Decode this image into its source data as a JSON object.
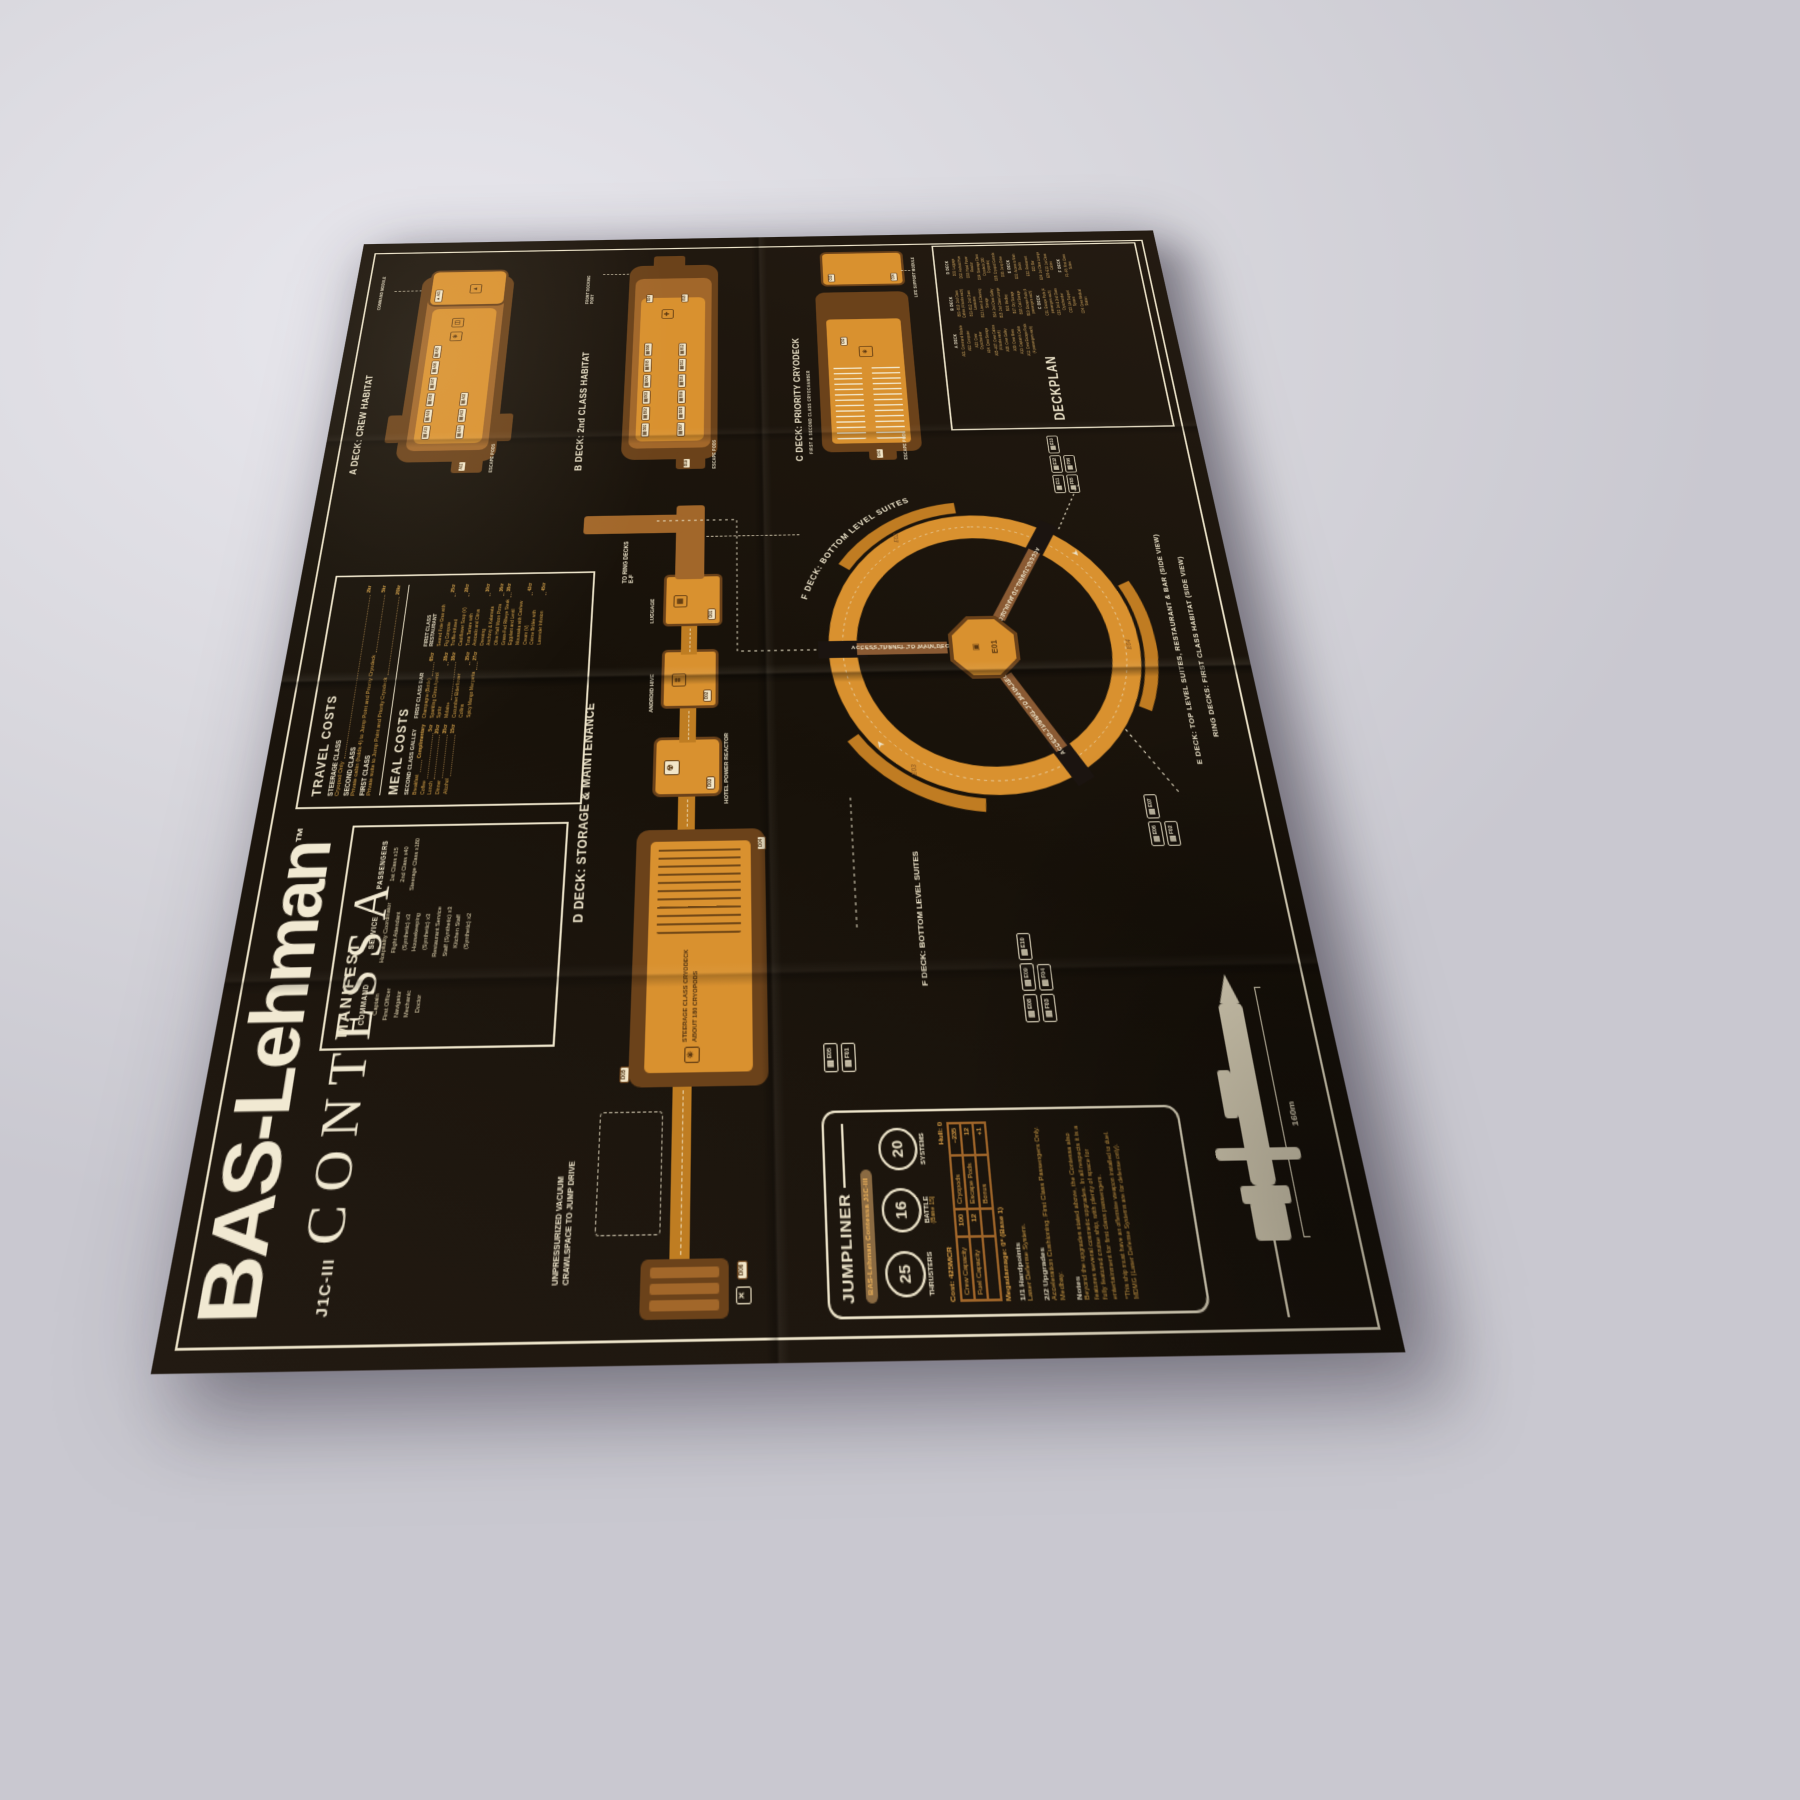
{
  "colors": {
    "accent_orange": "#d9912f",
    "deep_brown": "#6b421a",
    "cream": "#ece3c9",
    "mid_brown": "#a2672a",
    "gold_text": "#d9a449",
    "background": "#1b1410"
  },
  "icons": {
    "bunk": "▤",
    "window": "◫",
    "cryo": "✳",
    "reactor": "☢",
    "luggage": "▦",
    "hive": "⌗",
    "command": "▲",
    "medical": "✚",
    "jump": "✕",
    "hub": "▣",
    "columns": "⌸"
  },
  "masthead": {
    "brand": "BAS-Lehman",
    "tm": "™",
    "model": "J1C-III",
    "name": "CONTESSA"
  },
  "manifest": {
    "header": "MANIFEST",
    "command": {
      "title": "COMMAND",
      "items": [
        "Captain",
        "First Officer",
        "Navigator",
        "Mechanic",
        "Doctor"
      ]
    },
    "service": {
      "title": "SERVICE",
      "items": [
        "Hospitality Coordinator",
        "Flight Attendant (Synthetic) x3",
        "Housekeeping (Synthetic) x3",
        "Restaurant Service Staff (Synthetic) x3",
        "Kitchen Staff (Synthetic) x2"
      ]
    },
    "passengers": {
      "title": "PASSENGERS",
      "items": [
        "1st Class x15",
        "2nd Class x40",
        "Steerage Class x180"
      ]
    }
  },
  "costs": {
    "travel_header": "TRAVEL COSTS",
    "travel": [
      {
        "cls": "STEERAGE CLASS",
        "desc": "Cryopod Only",
        "price": "2kr"
      },
      {
        "cls": "SECOND CLASS",
        "desc": "Private cabin (holds 4) to Jump Point and Priority Cryodeck",
        "price": "5kr"
      },
      {
        "cls": "FIRST CLASS",
        "desc": "Private suite to Jump Point and Priority Cryodeck",
        "price": "20kr"
      }
    ],
    "meal_header": "MEAL COSTS",
    "galley": {
      "title": "SECOND CLASS GALLEY",
      "items": [
        {
          "n": "Breakfast",
          "p": "Complimentary"
        },
        {
          "n": "Coffee",
          "p": "5cr"
        },
        {
          "n": "Lunch",
          "p": "20cr"
        },
        {
          "n": "Dinner",
          "p": "35cr"
        },
        {
          "n": "Alcohol",
          "p": "15cr"
        }
      ]
    },
    "bar": {
      "title": "FIRST CLASS BAR",
      "items": [
        {
          "n": "Champagne (Bottle)",
          "p": "65cr"
        },
        {
          "n": "Sparkling Citrus Aperol Spritz",
          "p": "28cr"
        },
        {
          "n": "Molais+",
          "p": "38cr"
        },
        {
          "n": "Cucumber Elderflower Collins",
          "p": "35cr"
        },
        {
          "n": "Spicy Mango Margarita",
          "p": "27cr"
        }
      ]
    },
    "restaurant": {
      "title": "FIRST CLASS RESTAURANT",
      "items": [
        {
          "n": "Seared Foie Gras with Fig Compote",
          "p": "25cr"
        },
        {
          "n": "Truffle-infused Cauliflower Soup (V)",
          "p": "28cr"
        },
        {
          "n": "Tuna Tartare with Avocado and Citrus Dressing",
          "p": "30cr"
        },
        {
          "n": "Anchovy & Kalamata Olive Half Moon Pizza",
          "p": "36cr"
        },
        {
          "n": "Grass-Fed Ribeye Steak",
          "p": "38cr"
        },
        {
          "n": "Eggplant and Lentil Moussaka with Cashew Cream (V)",
          "p": "42cr"
        },
        {
          "n": "Crème Brûlée with Lavender Infusion",
          "p": "45cr"
        }
      ]
    }
  },
  "decks": {
    "a": {
      "title": "A DECK: CREW HABITAT",
      "row1": [
        "A10",
        "A09",
        "A08",
        "A07",
        "A06",
        "A05"
      ],
      "row2": [
        "A04",
        "A03",
        "A02"
      ]
    },
    "b": {
      "title": "B DECK: 2nd CLASS HABITAT",
      "row1": [
        "B01",
        "B02",
        "B03",
        "B04",
        "B05",
        "B06"
      ],
      "row2": [
        "B07",
        "B08",
        "B09",
        "B10",
        "B11",
        "B12"
      ]
    },
    "c": {
      "title": "C DECK: PRIORITY CRYODECK"
    },
    "d": {
      "title": "D DECK: STORAGE & MAINTENANCE"
    }
  },
  "rooms": {
    "a01": "A01",
    "a11": "A11",
    "b14": "B14",
    "b15": "B15",
    "b19": "B19",
    "c01": "C01",
    "c02": "C02",
    "c03": "C03",
    "c04": "C04",
    "d01": "D01",
    "d02": "D02",
    "d03": "D03",
    "d04": "D04",
    "d05": "D05",
    "d06": "D06",
    "e01": "E01"
  },
  "ann": {
    "escape_pods": "ESCAPE PODS",
    "command_module": "COMMAND MODULE",
    "front_docking": "FRONT DOCKING PORT",
    "life_support": "LIFE SUPPORT MODULE",
    "cryochamber": "FIRST & SECOND CLASS CRYOCHAMBER",
    "to_ring": "TO RING DECKS E-F",
    "luggage": "LUGGAGE",
    "android_hive": "ANDROID HIVE",
    "reactor": "HOTEL POWER REACTOR",
    "steerage1": "STEERAGE CLASS CRYODECK",
    "steerage2": "ABOUT 180 CRYOPODS",
    "crawl1": "UNPRESSURIZED VACUUM",
    "crawl2": "CRAWLSPACE TO JUMP DRIVE",
    "access_tunnel": "ACCESS TUNNEL TO MAIN DECKS"
  },
  "ring": {
    "f_curved": "F DECK: BOTTOM LEVEL SUITES",
    "f_label": "F DECK: BOTTOM LEVEL SUITES",
    "e_label": "E DECK: TOP LEVEL SUITES, RESTAURANT & BAR (SIDE VIEW)",
    "ring_label": "RING DECKS: FIRST CLASS HABITAT (SIDE VIEW)",
    "e02": "E02",
    "e03": "E03",
    "e04": "E04",
    "clusters": {
      "c1e": [
        "E05"
      ],
      "c1f": [
        "F01"
      ],
      "c2e": [
        "E06",
        "E07"
      ],
      "c2f": [
        "F02"
      ],
      "c3e": [
        "E08",
        "E09",
        "E10"
      ],
      "c3f": [
        "F03",
        "F04"
      ],
      "c4e": [
        "E11",
        "E12",
        "E13"
      ],
      "c4f": [
        "F05",
        "F06"
      ]
    }
  },
  "deckplan": {
    "header": "DECKPLAN",
    "a": {
      "title": "A DECK",
      "items": [
        "A01: Command Module",
        "A02: Computer",
        "A03: Crew Cryochamber",
        "A04: Crew Storage",
        "A05–A07: Crew Cabins (4 bunks each)",
        "A08: Crew Galley",
        "A09: Crew Mess",
        "A10: Captain's Cabin",
        "A11: Crew Escape Pods (4 passengers each)"
      ]
    },
    "b": {
      "title": "B DECK",
      "items": [
        "B01–B10: 2nd Class Cabins (4 bunks each)",
        "B11–B12: 2nd Class Lavatories",
        "B13: Linen & Cleaning Storage",
        "B14: 2nd Class Galley",
        "B15: 2nd Class Lounge",
        "B16: Medbay",
        "B17: Dry Storage",
        "B18: Cold Storage",
        "B19: Escape Pods (4 passengers each)"
      ]
    },
    "c": {
      "title": "C DECK",
      "items": [
        "C01: Escape Pods (4 passengers each)",
        "C02: 1st & 2nd Class Cryochamber",
        "C03: Life Support System",
        "C04: Crew Medical Station"
      ]
    },
    "d": {
      "title": "D DECK",
      "items": [
        "D01: Luggage",
        "D02: Android Hive",
        "D03: Hotel Power Reactor",
        "D04: Steerage Class Cryodeck (180 Cryopods)",
        "D05: Cryopod Controls",
        "D06: Jump Drive"
      ]
    },
    "e": {
      "title": "E DECK",
      "items": [
        "E01: Access to Main Decks",
        "E02: Restaurant",
        "E03: Bar",
        "E04: 1st Class Lounge",
        "E05–E13: 1st Class Cabins"
      ]
    },
    "f": {
      "title": "F DECK",
      "items": [
        "F1–F6: First Class Suites"
      ]
    }
  },
  "jumpliner": {
    "title": "JUMPLINER",
    "ship": "BAS-Lehman Contessa J1C-III",
    "circles": [
      {
        "v": "25",
        "label": "THRUSTERS",
        "sub": ""
      },
      {
        "v": "16",
        "label": "BATTLE",
        "sub": "(Base 15)"
      },
      {
        "v": "20",
        "label": "SYSTEMS",
        "sub": ""
      }
    ],
    "cost": "Cost: 425MCR",
    "hull": "Hull: 0",
    "table": {
      "crew_l": "Crew Capacity",
      "crew_v": "100",
      "cryo_l": "Cryopods",
      "cryo_v": "~235",
      "fuel_l": "Fuel Capacity",
      "fuel_v": "12",
      "esc_l": "Escape Pods",
      "esc_v": "12",
      "bonus_l": "Bonus",
      "bonus_v": "+1"
    },
    "mega": "Megadamage: 0* (Base 1)",
    "hard_h": "1/1 Hardpoints",
    "hard_t": "Laser Defense System.",
    "upg_h": "2/2 Upgrades",
    "upgrades": [
      "Acceleration Cushioning. First Class Passengers Only.",
      "Medbay."
    ],
    "notes_h": "Notes",
    "notes": "Beyond the upgrades stated above, the Contessa also features several cosmetic upgrades. In all respects it is a fully featured cruise ship, with plenty of space for entertainment for first class passengers.",
    "fn1": "*This ship must have an offensive weapon installed to duel.",
    "fn2": "MDMG (Laser Defense Systems are for defense only)."
  },
  "ship_view": {
    "length": "160m"
  }
}
